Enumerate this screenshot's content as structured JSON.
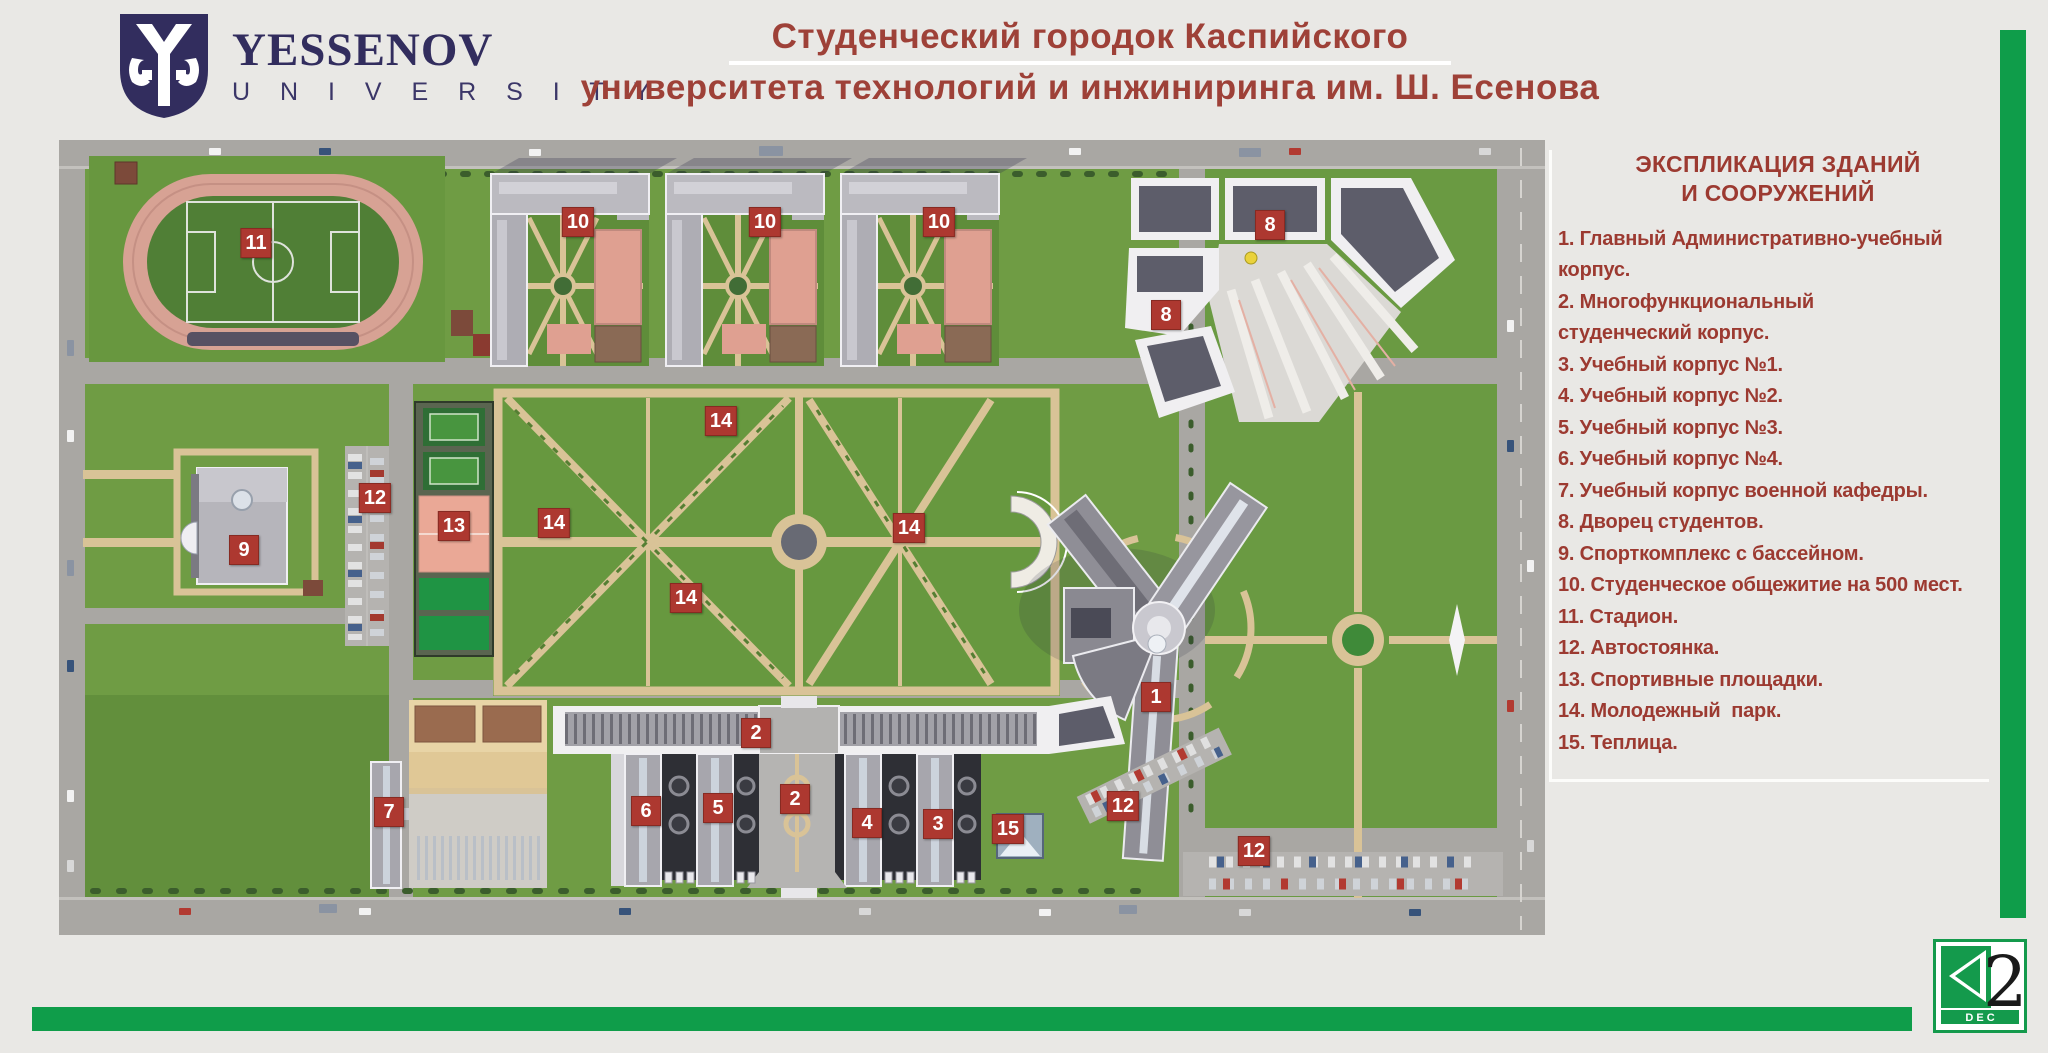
{
  "header": {
    "logo": {
      "name": "YESSENOV",
      "subname": "U N I V E R S I T Y"
    },
    "title_line1": "Студенческий городок Каспийского",
    "title_line2": "университета технологий и инжиниринга им. Ш. Есенова"
  },
  "legend": {
    "title_line1": "ЭКСПЛИКАЦИЯ ЗДАНИЙ",
    "title_line2": "И СООРУЖЕНИЙ",
    "items": [
      "1. Главный Административно-учебный\nкорпус.",
      "2. Многофункциональный\nстуденческий корпус.",
      "3. Учебный корпус №1.",
      "4. Учебный корпус №2.",
      "5. Учебный корпус №3.",
      "6. Учебный корпус №4.",
      "7. Учебный корпус военной кафедры.",
      "8. Дворец студентов.",
      "9. Спорткомплекс с бассейном.",
      "10. Студенческое общежитие на 500 мест.",
      "11. Стадион.",
      "12. Автостоянка.",
      "13. Спортивные площадки.",
      "14. Молодежный  парк.",
      "15. Теплица."
    ]
  },
  "map": {
    "markers": [
      {
        "label": "11",
        "x": 197,
        "y": 103
      },
      {
        "label": "10",
        "x": 519,
        "y": 82
      },
      {
        "label": "10",
        "x": 706,
        "y": 82
      },
      {
        "label": "10",
        "x": 880,
        "y": 82
      },
      {
        "label": "8",
        "x": 1211,
        "y": 85
      },
      {
        "label": "8",
        "x": 1107,
        "y": 175
      },
      {
        "label": "14",
        "x": 662,
        "y": 281
      },
      {
        "label": "14",
        "x": 495,
        "y": 383
      },
      {
        "label": "14",
        "x": 850,
        "y": 388
      },
      {
        "label": "14",
        "x": 627,
        "y": 458
      },
      {
        "label": "12",
        "x": 316,
        "y": 358
      },
      {
        "label": "13",
        "x": 395,
        "y": 386
      },
      {
        "label": "9",
        "x": 185,
        "y": 410
      },
      {
        "label": "1",
        "x": 1097,
        "y": 557
      },
      {
        "label": "2",
        "x": 697,
        "y": 593
      },
      {
        "label": "2",
        "x": 736,
        "y": 659
      },
      {
        "label": "6",
        "x": 587,
        "y": 671
      },
      {
        "label": "5",
        "x": 659,
        "y": 668
      },
      {
        "label": "4",
        "x": 808,
        "y": 683
      },
      {
        "label": "3",
        "x": 879,
        "y": 684
      },
      {
        "label": "15",
        "x": 949,
        "y": 689
      },
      {
        "label": "7",
        "x": 330,
        "y": 672
      },
      {
        "label": "12",
        "x": 1064,
        "y": 666
      },
      {
        "label": "12",
        "x": 1195,
        "y": 711
      }
    ]
  },
  "footer": {
    "brand": {
      "two": "2",
      "dec": "D E C"
    }
  },
  "colors": {
    "title_red": "#9e4138",
    "legend_red": "#9c3a31",
    "marker_red": "#ad3830",
    "brand_green": "#0f9d4a",
    "logo_navy": "#322d5e",
    "map_green": "#6f9c44",
    "road_gray": "#a9a7a3",
    "path_tan": "#d9c397"
  }
}
